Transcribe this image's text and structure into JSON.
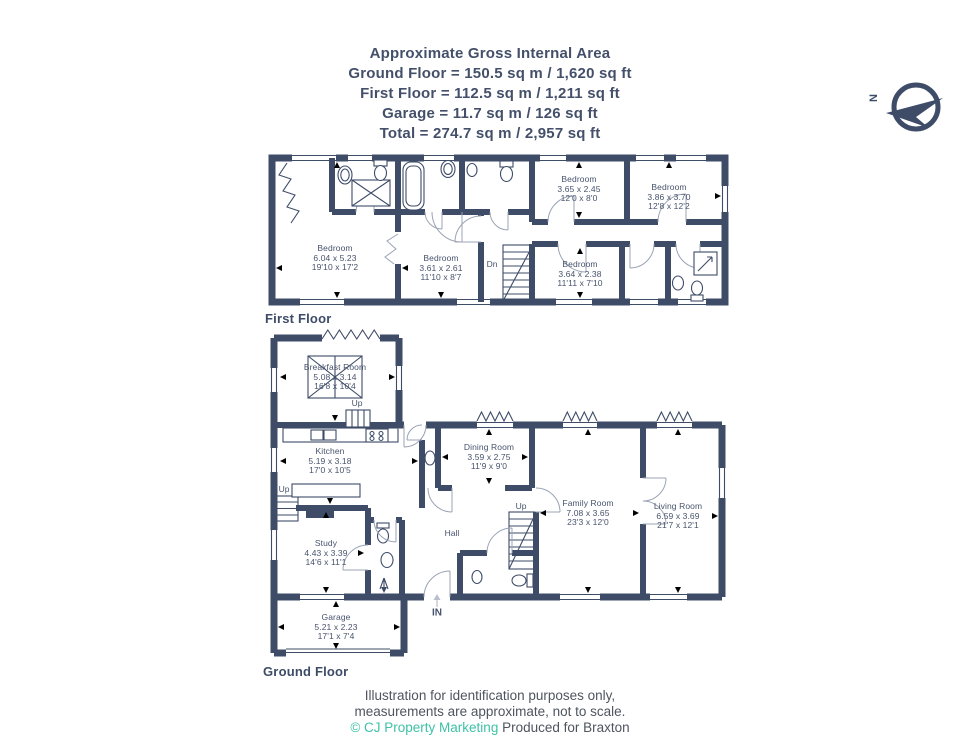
{
  "header": {
    "title": "Approximate Gross Internal Area",
    "lines": [
      "Ground Floor = 150.5 sq m / 1,620 sq ft",
      "First Floor = 112.5 sq m / 1,211 sq ft",
      "Garage = 11.7 sq m / 126 sq ft",
      "Total = 274.7 sq m / 2,957 sq ft"
    ]
  },
  "compass": {
    "label": "N"
  },
  "first_floor": {
    "label": "First Floor",
    "stairs_label": "Dn",
    "rooms": [
      {
        "name": "Bedroom",
        "metric": "6.04 x 5.23",
        "imperial": "19'10 x 17'2"
      },
      {
        "name": "Bedroom",
        "metric": "3.61 x 2.61",
        "imperial": "11'10 x 8'7"
      },
      {
        "name": "Bedroom",
        "metric": "3.65 x 2.45",
        "imperial": "12'0 x 8'0"
      },
      {
        "name": "Bedroom",
        "metric": "3.86 x 3.70",
        "imperial": "12'8 x 12'2"
      },
      {
        "name": "Bedroom",
        "metric": "3.64 x 2.38",
        "imperial": "11'11 x 7'10"
      }
    ]
  },
  "ground_floor": {
    "label": "Ground Floor",
    "hall_label": "Hall",
    "stairs_label": "Up",
    "breakfast_steps_label": "Up",
    "kitchen_steps_label": "Up",
    "entrance_label": "IN",
    "rooms": [
      {
        "name": "Breakfast Room",
        "metric": "5.08 x 3.14",
        "imperial": "16'8 x 10'4"
      },
      {
        "name": "Kitchen",
        "metric": "5.19 x 3.18",
        "imperial": "17'0 x 10'5"
      },
      {
        "name": "Dining Room",
        "metric": "3.59 x 2.75",
        "imperial": "11'9 x 9'0"
      },
      {
        "name": "Family Room",
        "metric": "7.08 x 3.65",
        "imperial": "23'3 x 12'0"
      },
      {
        "name": "Living Room",
        "metric": "6.59 x 3.69",
        "imperial": "21'7 x 12'1"
      },
      {
        "name": "Study",
        "metric": "4.43 x 3.39",
        "imperial": "14'6 x 11'1"
      },
      {
        "name": "Garage",
        "metric": "5.21 x 2.23",
        "imperial": "17'1 x 7'4"
      }
    ]
  },
  "footer": {
    "line1": "Illustration for identification purposes only,",
    "line2": "measurements are approximate, not to scale.",
    "credit_teal": "© CJ Property Marketing",
    "credit_rest": " Produced for Braxton"
  },
  "colors": {
    "wall": "#3e4c68",
    "accent_teal": "#3ec2a8",
    "door_arc": "#9aa3b5"
  }
}
